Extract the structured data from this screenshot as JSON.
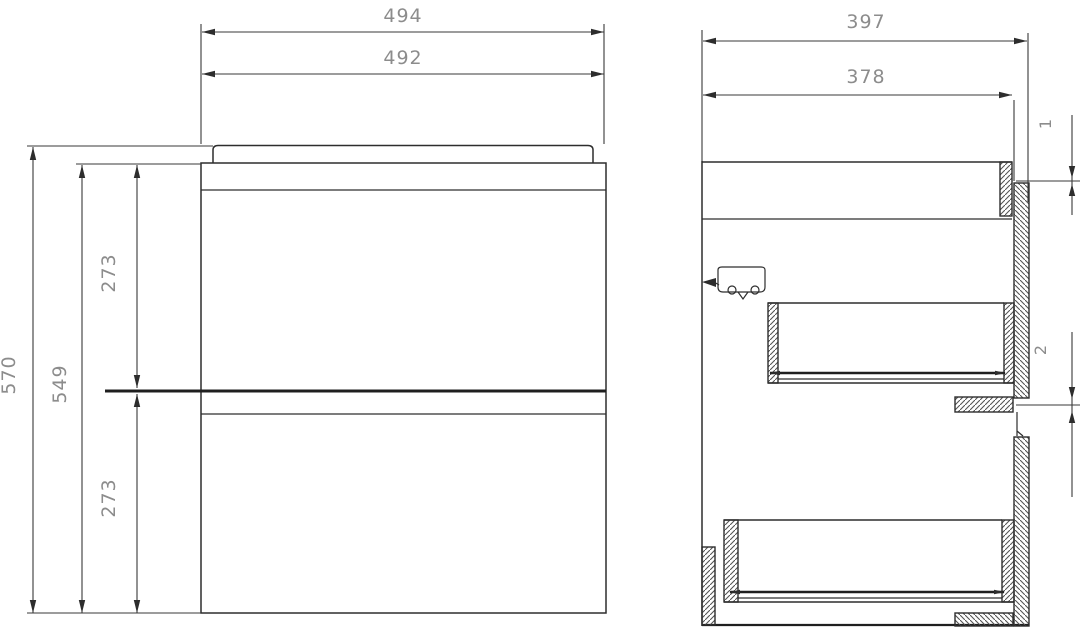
{
  "front_view": {
    "overall_width": "494",
    "carcass_width": "492",
    "overall_height": "570",
    "carcass_height": "549",
    "upper_drawer_height": "273",
    "lower_drawer_height": "273"
  },
  "side_view": {
    "overall_depth": "397",
    "carcass_depth": "378",
    "top_reveal": "1",
    "mid_reveal": "2"
  },
  "colors": {
    "line": "#2d2d2d",
    "dimension_text": "#8c8c8c",
    "hatch": "#555555",
    "background": "#ffffff"
  }
}
